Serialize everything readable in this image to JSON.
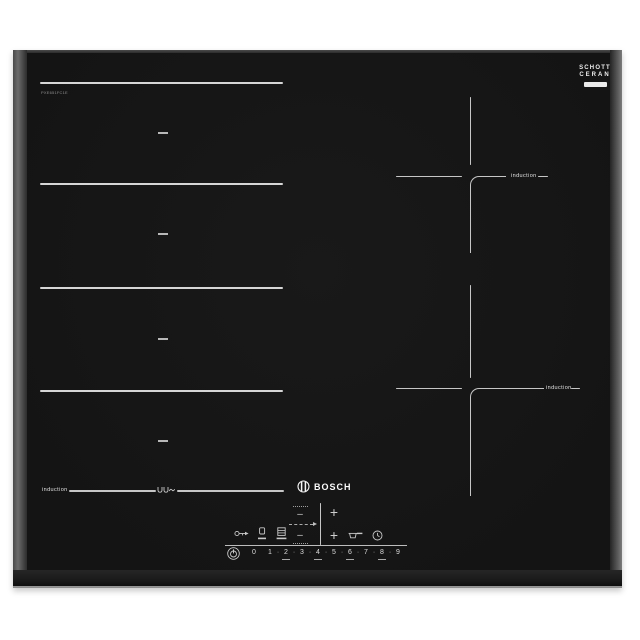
{
  "product": {
    "brand": "BOSCH",
    "model": "PXE651FC1E"
  },
  "glass_badge": {
    "line1": "SCHOTT",
    "line2": "CERAN"
  },
  "zones": {
    "flex_label": "induction",
    "top_right_label": "induction",
    "bottom_right_label": "induction"
  },
  "controls": {
    "minus": "–",
    "plus": "+",
    "separator": "·",
    "levels": [
      "0",
      "1",
      "2",
      "3",
      "4",
      "5",
      "6",
      "7",
      "8",
      "9"
    ],
    "icons": {
      "power": "power-icon",
      "key_lock": "key-lock-icon",
      "boost": "boost-icon",
      "zone_select": "zone-select-icon",
      "move_pan": "move-pan-arrow-icon",
      "pan": "pan-icon",
      "timer": "timer-clock-icon",
      "flex_pans": "flex-pans-icon",
      "bosch_emblem": "bosch-emblem-icon"
    }
  },
  "colors": {
    "background": "#ffffff",
    "glass": "#161616",
    "frame": "#3c3c3c",
    "marking": "#c9c9c9",
    "text": "#e8e8e8"
  }
}
